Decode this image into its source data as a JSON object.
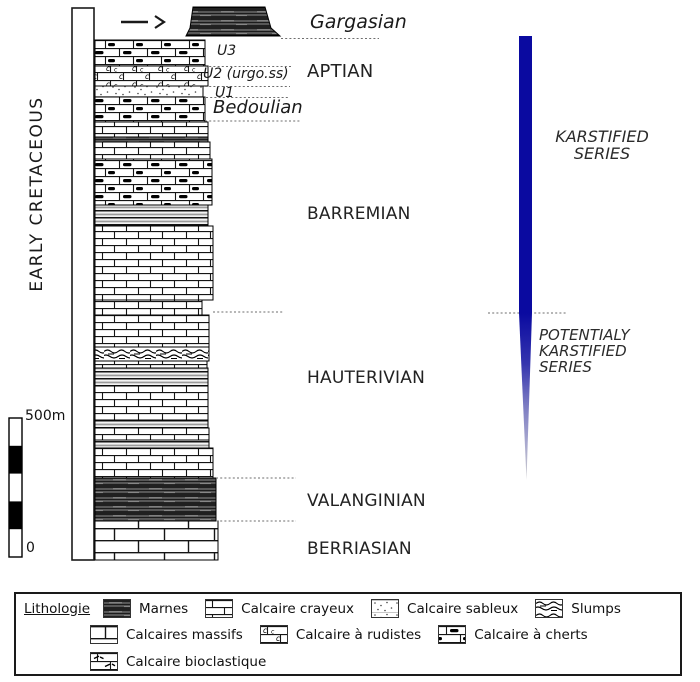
{
  "period": {
    "label": "EARLY CRETACEOUS"
  },
  "stages": {
    "gargasian": "Gargasian",
    "u3": "U3",
    "u2": "U2 (urgo.ss)",
    "aptian": "APTIAN",
    "u1": "U1",
    "bedoulian": "Bedoulian",
    "barremian": "BARREMIAN",
    "hauterivian": "HAUTERIVIAN",
    "valanginian": "VALANGINIAN",
    "berriasian": "BERRIASIAN"
  },
  "karst": {
    "karstified_label": "KARSTIFIED\nSERIES",
    "potentially_label": "POTENTIALY\nKARSTIFIED\nSERIES",
    "bar_color": "#0a0aa0"
  },
  "scale": {
    "top_label": "500m",
    "bottom_label": "0"
  },
  "legend": {
    "title": "Lithologie",
    "items": [
      {
        "label": "Marnes",
        "pattern": "marnes"
      },
      {
        "label": "Calcaire crayeux",
        "pattern": "brick"
      },
      {
        "label": "Calcaire sableux",
        "pattern": "sableux"
      },
      {
        "label": "Slumps",
        "pattern": "slumps"
      },
      {
        "label": "Calcaires massifs",
        "pattern": "brick-big"
      },
      {
        "label": "Calcaire à rudistes",
        "pattern": "rudistes"
      },
      {
        "label": "Calcaire à cherts",
        "pattern": "cherts"
      },
      {
        "label": "Calcaire bioclastique",
        "pattern": "bioclastic"
      }
    ]
  }
}
